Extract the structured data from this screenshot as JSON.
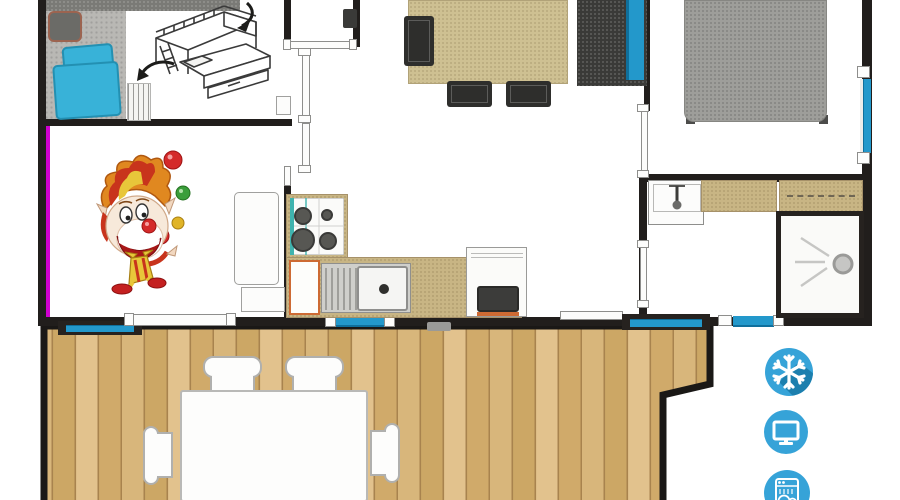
{
  "canvas": {
    "width": 900,
    "height": 500
  },
  "palette": {
    "wall": "#211e1c",
    "magenta": "#cf00cf",
    "win_blue": "#2398cb",
    "win_blue_dark": "#0f6f9c",
    "floor_gray": "#b9b8b4",
    "band_gray": "#7a7a76",
    "teal": "#38b2d8",
    "table_tan": "#cec092",
    "counter_tan": "#c8b584",
    "dark": "#3a3a38",
    "bed_gray": "#9e9e9a",
    "wood": "#d7b47a",
    "wood_dark": "#a8834e",
    "icon_blue": "#36a3d8",
    "icon_shadow": "#1c7fae",
    "orange": "#cd6a33",
    "ink": "#3a3a3a"
  },
  "floorplan": {
    "type": "mobile-home top-view floor plan with wooden terrace",
    "elements": [
      "bedroom-bed-with-teal-pillows",
      "desk-chair",
      "wardrobe-band",
      "bunk-ladder",
      "bunk-bed-sketch",
      "clown-illustration",
      "dining-table",
      "dining-chairs",
      "sofa-with-blue-cushion",
      "double-bed",
      "bathroom-sink",
      "bathroom-counter",
      "wardrobe",
      "shower",
      "stove-4-burners",
      "kitchen-sink",
      "kitchen-cabinet",
      "appliance-unit",
      "terrace-deck",
      "terrace-table",
      "terrace-chairs",
      "windows",
      "sliding-doors"
    ]
  },
  "amenities": {
    "icons": [
      {
        "name": "snowflake-icon"
      },
      {
        "name": "tv-icon"
      },
      {
        "name": "dishwasher-icon"
      }
    ]
  }
}
